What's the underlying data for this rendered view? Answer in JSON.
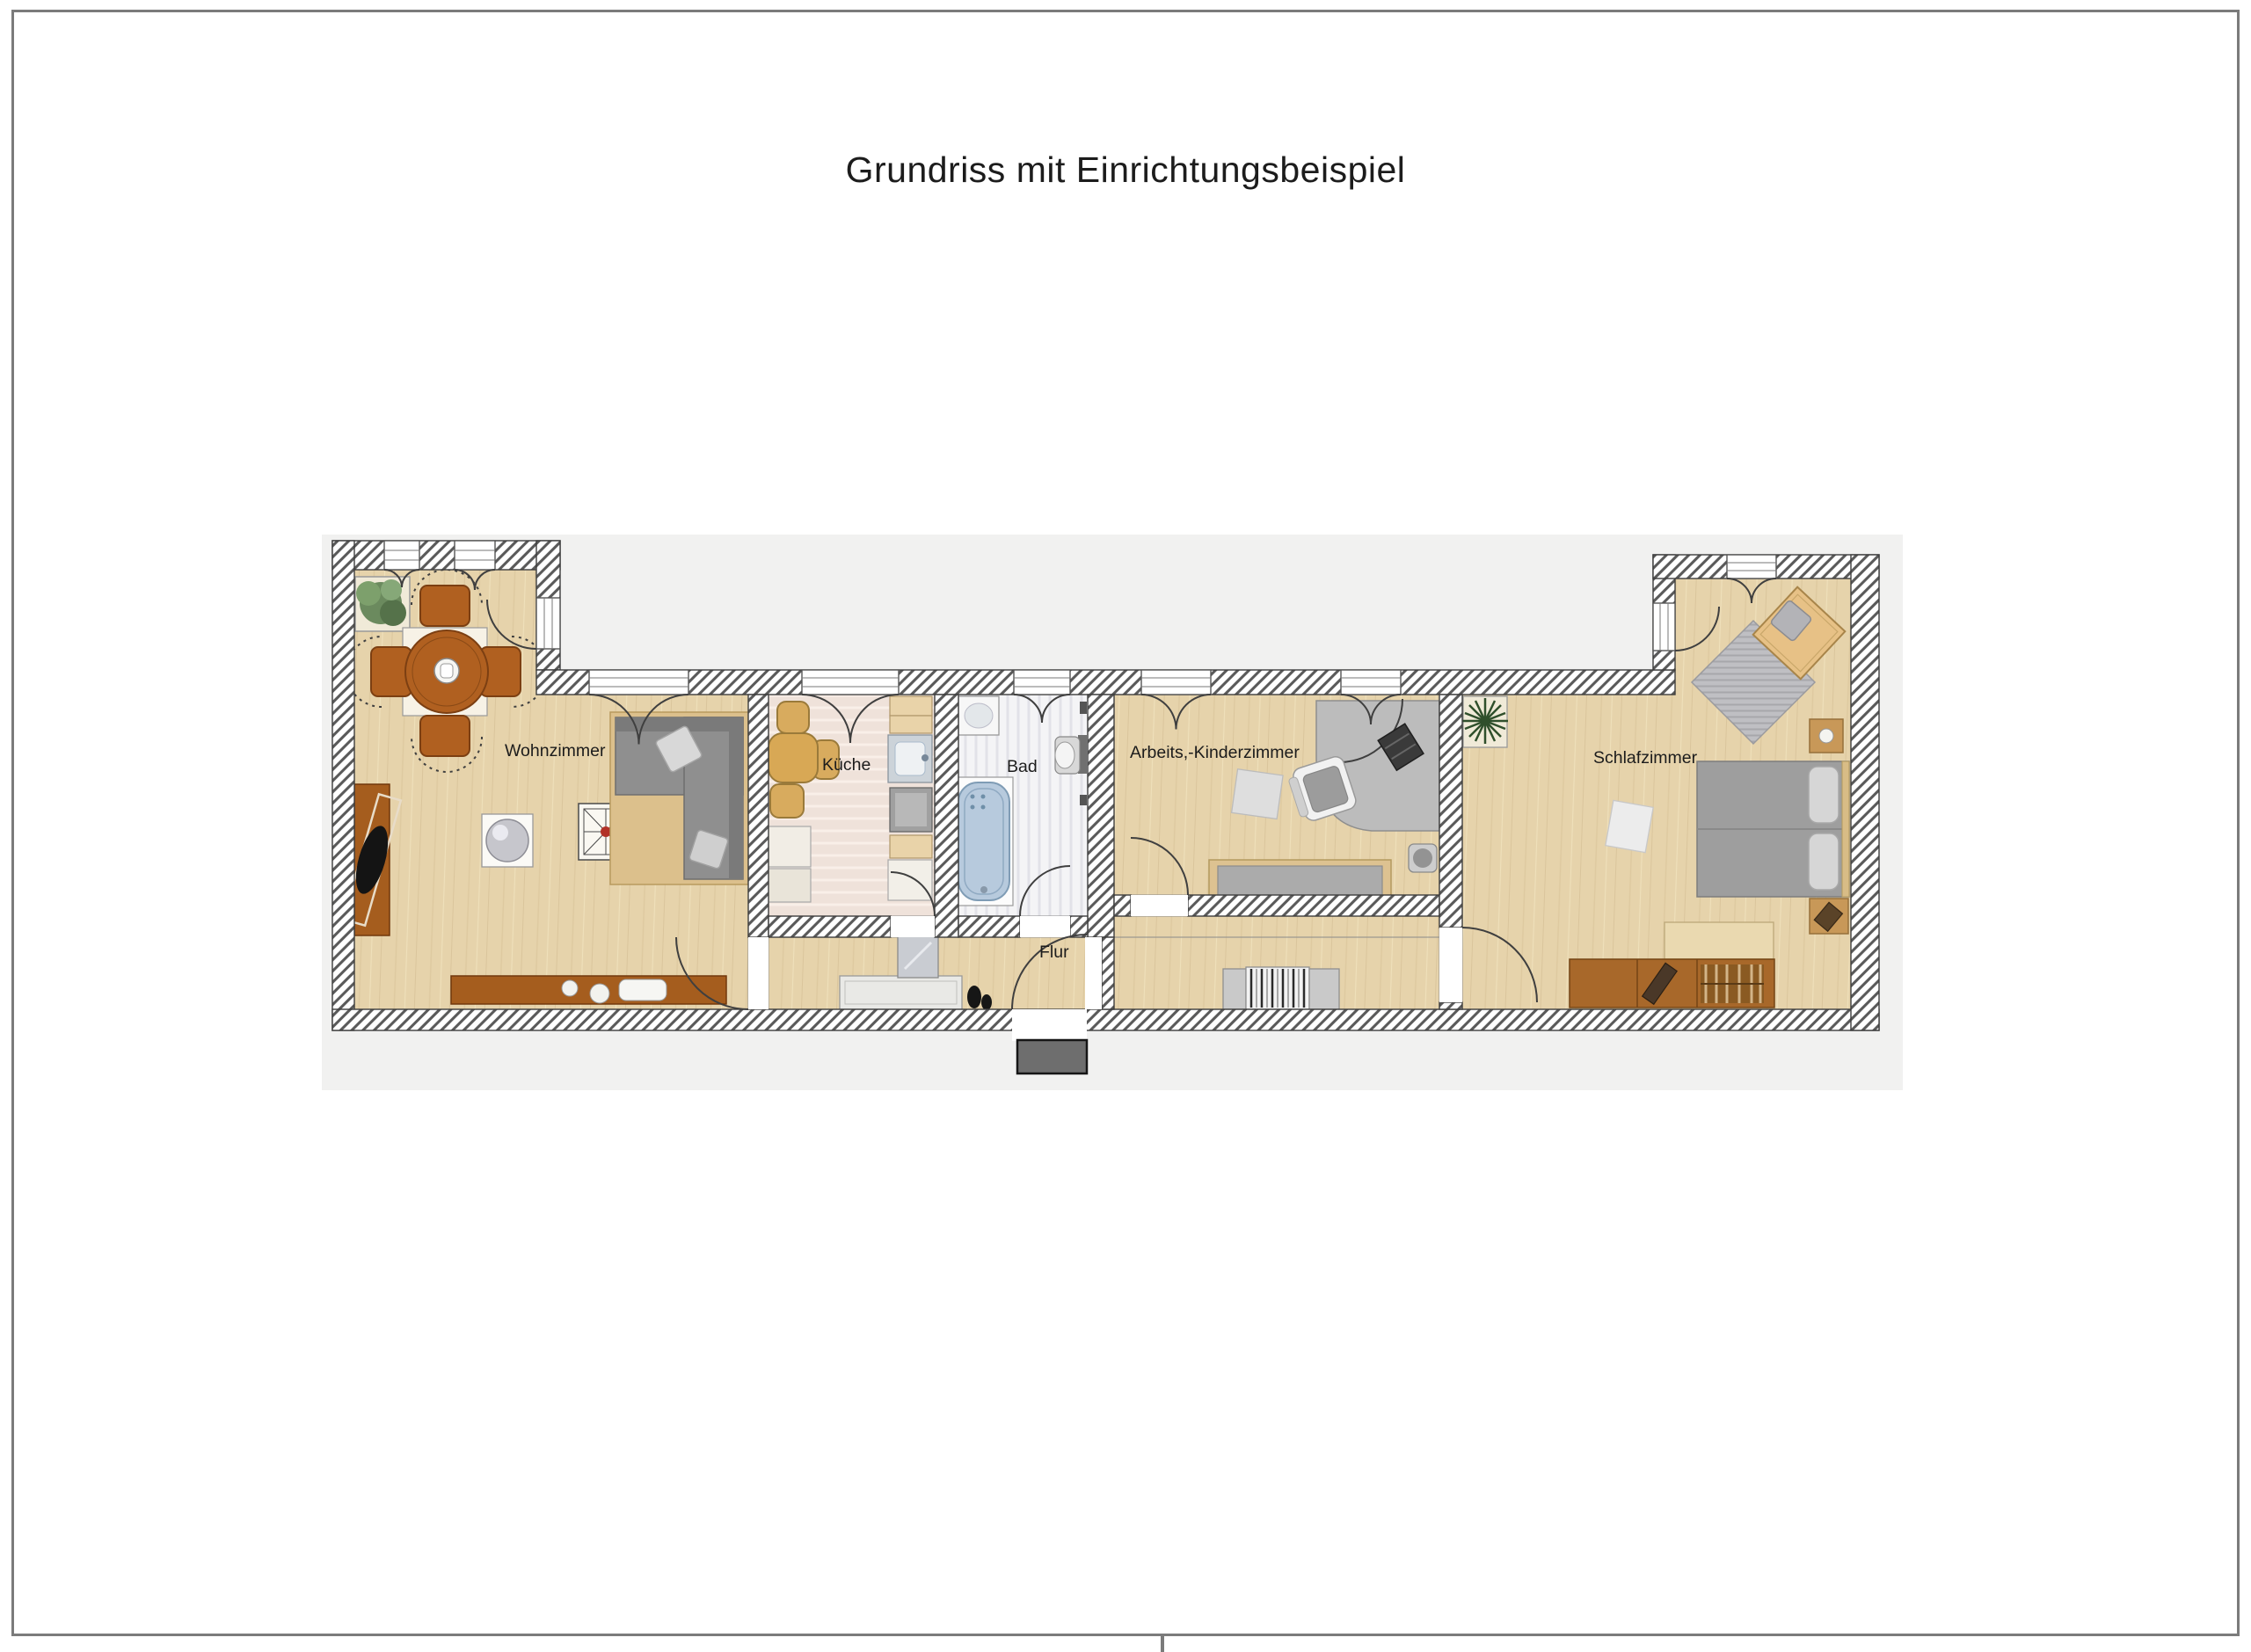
{
  "page": {
    "title": "Grundriss mit Einrichtungsbeispiel"
  },
  "rooms": {
    "wohnzimmer": {
      "label": "Wohnzimmer"
    },
    "kueche": {
      "label": "Küche"
    },
    "bad": {
      "label": "Bad"
    },
    "arbeitszimmer": {
      "label": "Arbeits,-Kinderzimmer"
    },
    "schlafzimmer": {
      "label": "Schlafzimmer"
    },
    "flur": {
      "label": "Flur"
    }
  },
  "colors": {
    "frame_gray": "#7b7b7b",
    "backdrop_gray": "#f1f1f0",
    "label_color": "#1c1c1c",
    "wall_outline": "#3d3d3d",
    "wall_hatch_line": "#5a5a5a",
    "floor_wood": "#e6d3ab",
    "kitchen_floor": "#efe2da",
    "bath_floor": "#f4f4f6",
    "furniture_brown": "#a55d1e",
    "dining_brown": "#b06020",
    "furniture_tan": "#d8ab5e",
    "sofa_gray": "#8f8f8f",
    "desk_gray": "#bcbcbc",
    "bed_gray": "#9e9e9e",
    "bathtub_blue": "#b7cadd",
    "plant_green": "#5d7c52",
    "doormat_gray": "#6e6e6e"
  }
}
